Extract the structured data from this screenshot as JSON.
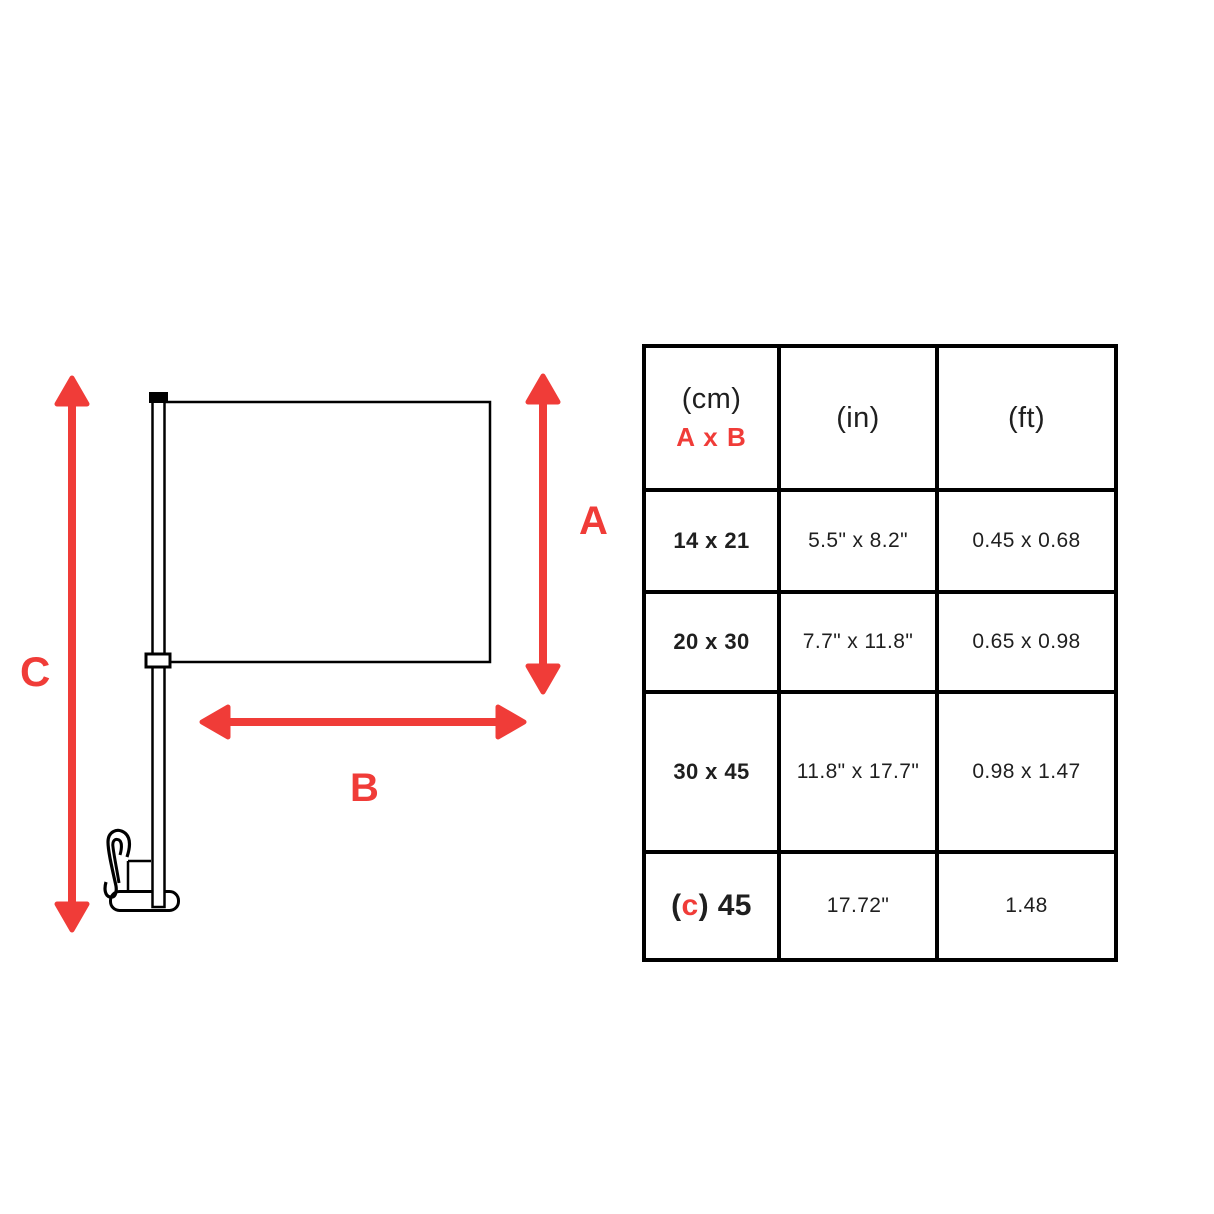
{
  "diagram": {
    "label_a": "A",
    "label_b": "B",
    "label_c": "C",
    "arrow_color": "#f03c38",
    "outline_color": "#000000"
  },
  "table": {
    "border_color": "#000000",
    "accent_color": "#f03c38",
    "header": {
      "cm": "(cm)",
      "axb": "A x B",
      "in": "(in)",
      "ft": "(ft)"
    },
    "rows": [
      {
        "cm": "14 x 21",
        "in": "5.5\" x 8.2\"",
        "ft": "0.45 x 0.68"
      },
      {
        "cm": "20 x 30",
        "in": "7.7\" x 11.8\"",
        "ft": "0.65 x 0.98"
      },
      {
        "cm": "30 x 45",
        "in": "11.8\" x 17.7\"",
        "ft": "0.98 x 1.47"
      },
      {
        "cm_parts": {
          "open": "(",
          "c": "c",
          "rest": ") 45"
        },
        "in": "17.72\"",
        "ft": "1.48"
      }
    ]
  }
}
